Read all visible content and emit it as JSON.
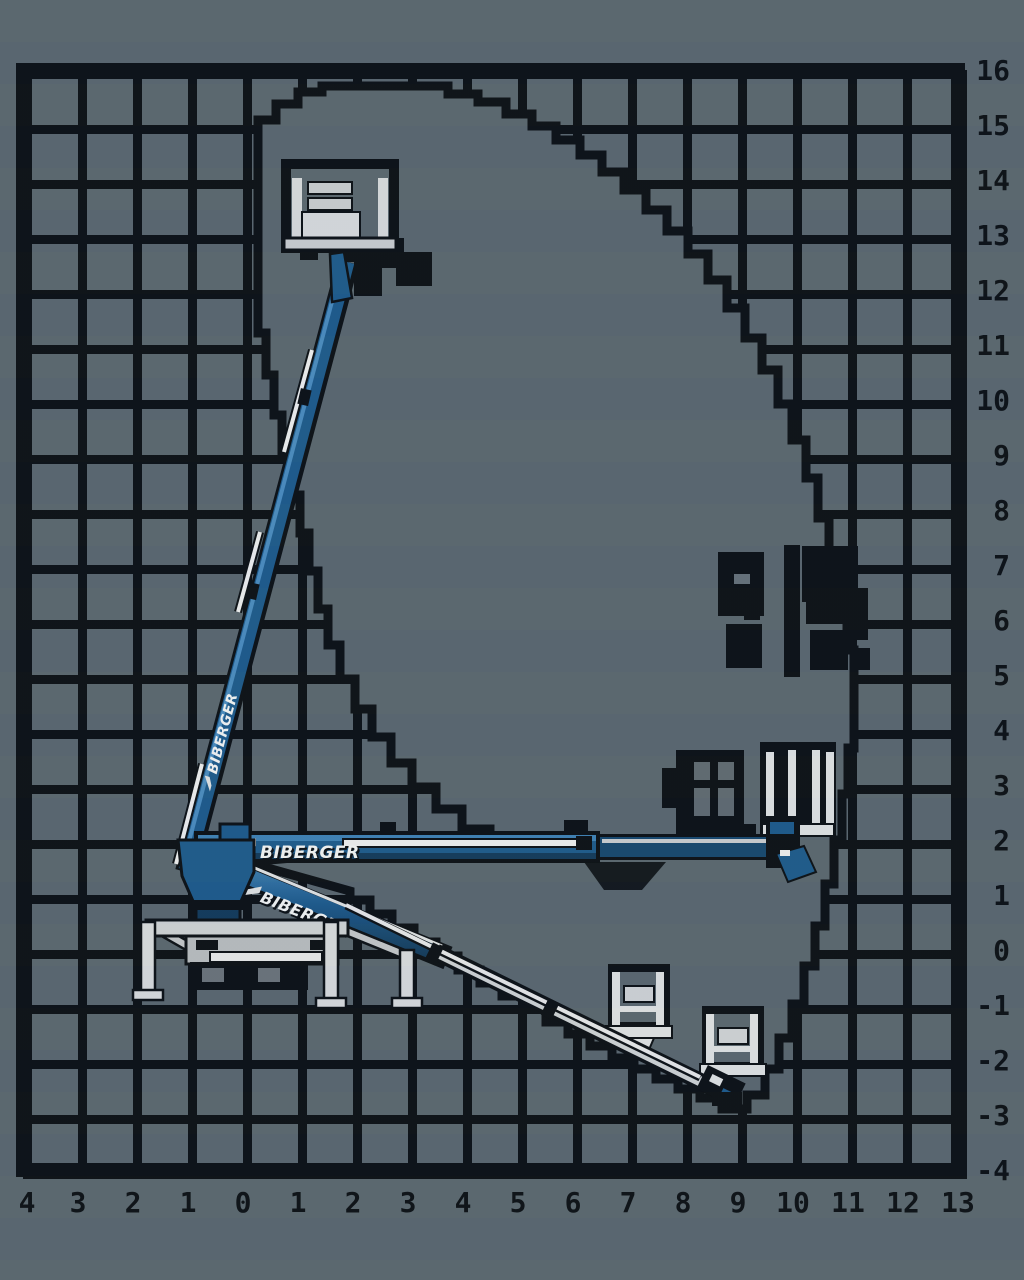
{
  "diagram": {
    "brand": "BIBERGER",
    "boom_labels": {
      "upper_boom": "BIBERGER",
      "horizontal_boom": "BIBERGER",
      "lower_boom": "BIBERGER"
    },
    "axes": {
      "x_labels": [
        "4",
        "3",
        "2",
        "1",
        "0",
        "1",
        "2",
        "3",
        "4",
        "5",
        "6",
        "7",
        "8",
        "9",
        "10",
        "11",
        "12",
        "13"
      ],
      "y_labels": [
        "16",
        "15",
        "14",
        "13",
        "12",
        "11",
        "10",
        "9",
        "8",
        "7",
        "6",
        "5",
        "4",
        "3",
        "2",
        "1",
        "0",
        "-1",
        "-2",
        "-3",
        "-4"
      ]
    },
    "colors": {
      "background": "#5a6770",
      "ink": "#0b1016",
      "boom_blue": "#1d5a8c",
      "boom_blue_dark": "#123a5c",
      "boom_blue_light": "#4a8cc0",
      "silver": "#ced2d5",
      "white": "#eceef0"
    },
    "chart_data": {
      "type": "area",
      "title": "Working envelope reach diagram",
      "xlabel": "outreach (m)",
      "ylabel": "height (m)",
      "x_range": [
        -4,
        13
      ],
      "y_range": [
        -4,
        16
      ],
      "grid": true,
      "envelope_outline_m": [
        [
          0.3,
          14.6
        ],
        [
          0.3,
          15.5
        ],
        [
          1.4,
          15.7
        ],
        [
          3.7,
          15.7
        ],
        [
          6.0,
          14.3
        ],
        [
          8.0,
          12.2
        ],
        [
          9.6,
          9.9
        ],
        [
          10.7,
          7.4
        ],
        [
          11.1,
          5.4
        ],
        [
          11.1,
          3.6
        ],
        [
          10.6,
          1.6
        ],
        [
          9.8,
          -0.4
        ],
        [
          8.7,
          -2.8
        ],
        [
          1.9,
          -0.9
        ],
        [
          0.1,
          1.6
        ],
        [
          0.3,
          5.5
        ],
        [
          0.8,
          8.0
        ],
        [
          0.3,
          11.2
        ]
      ]
    }
  }
}
